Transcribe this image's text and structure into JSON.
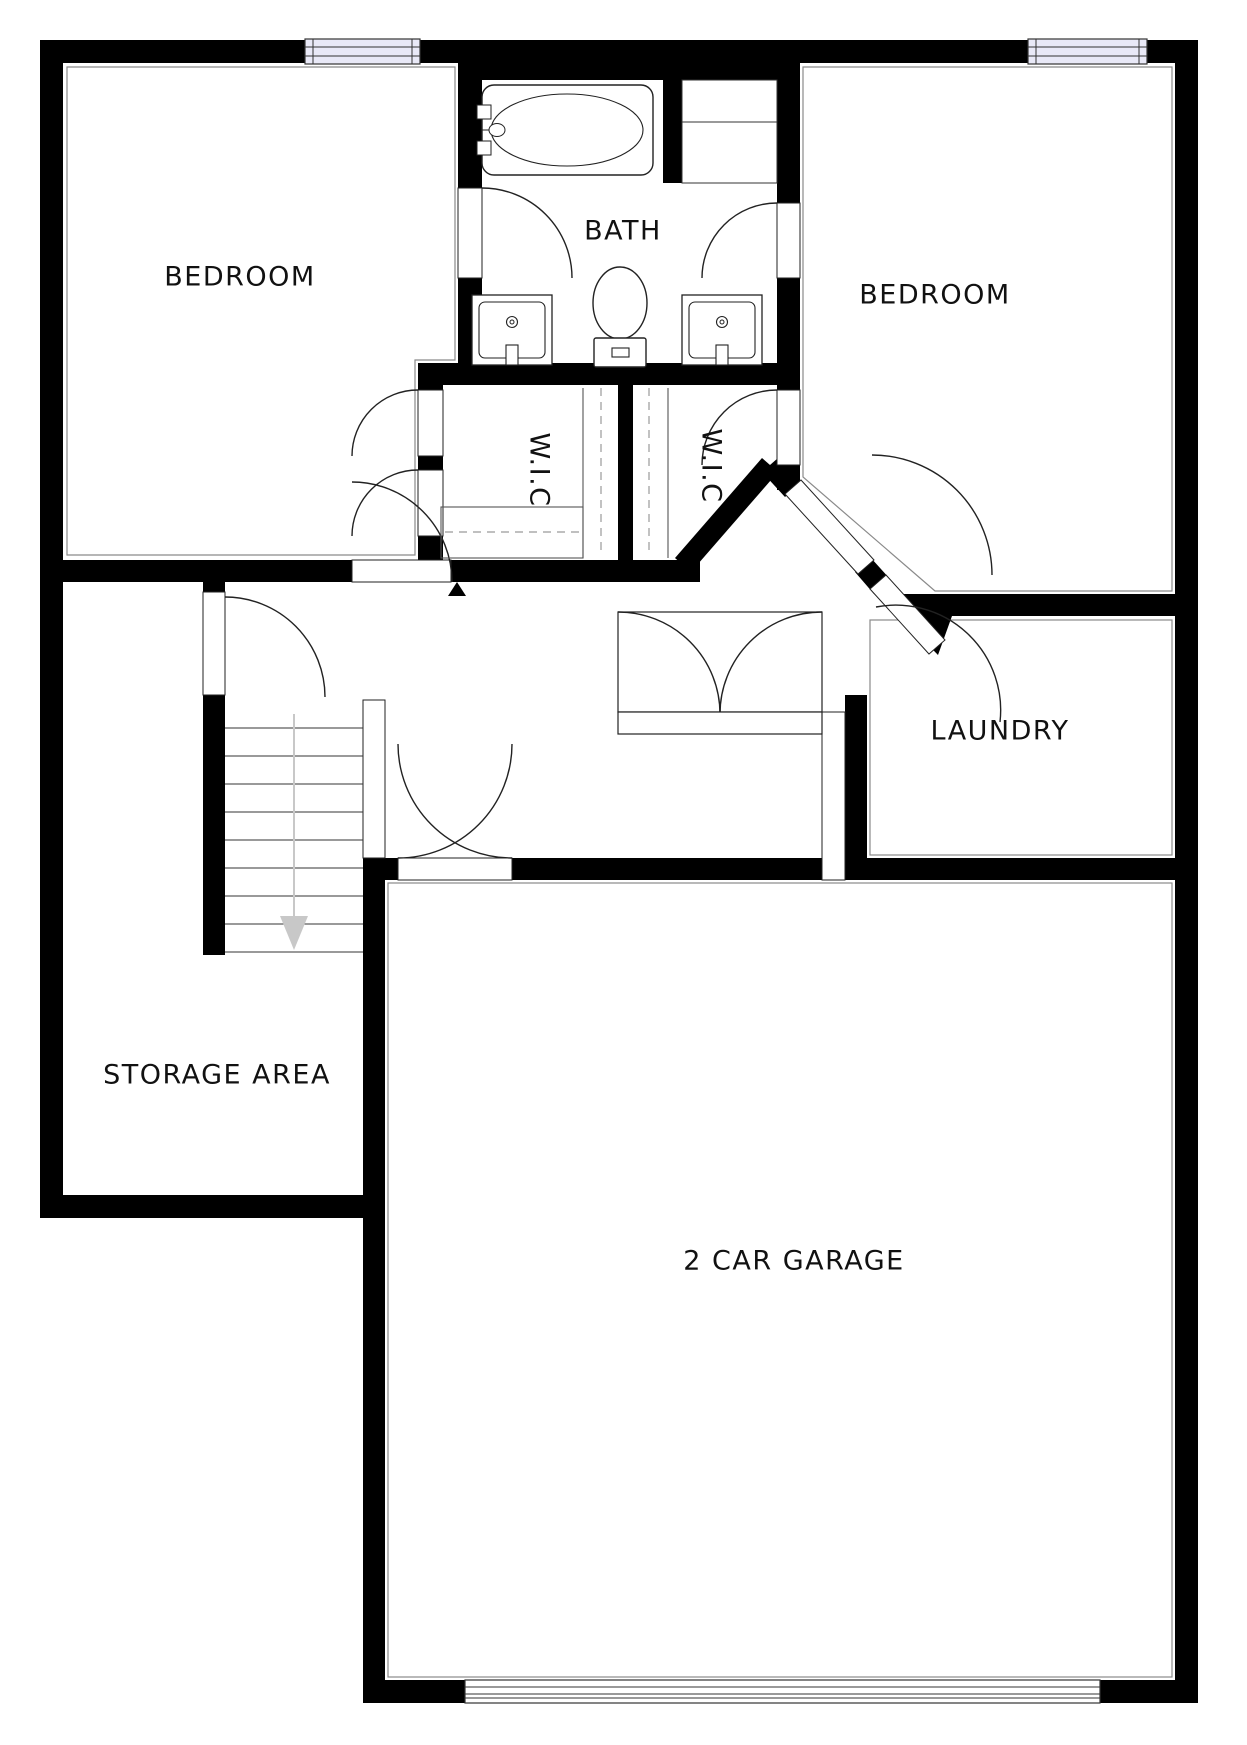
{
  "floorplan": {
    "labels": {
      "bedroom_left": "BEDROOM",
      "bedroom_right": "BEDROOM",
      "bath": "BATH",
      "wic_left": "W.I.C",
      "wic_right": "W.I.C",
      "laundry": "LAUNDRY",
      "storage": "STORAGE AREA",
      "garage": "2 CAR GARAGE"
    },
    "colors": {
      "wall": "#000000",
      "window_fill": "#e9e9f7",
      "door_line": "#222222",
      "stair_arrow": "#c8c8c8",
      "room_inset_line": "#8a8a8a"
    }
  }
}
